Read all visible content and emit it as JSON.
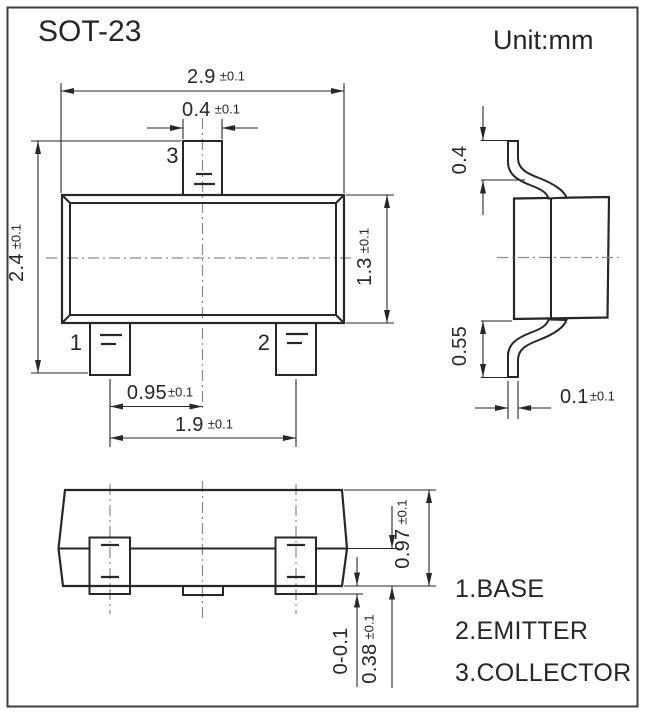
{
  "title": "SOT-23",
  "unit_label": "Unit:mm",
  "colors": {
    "ink": "#26262b",
    "centerline": "#8a8a8a",
    "border": "#3e3e46",
    "background": "#ffffff"
  },
  "front_view": {
    "pin1_label": "1",
    "pin2_label": "2",
    "pin3_label": "3",
    "dim_body_width": {
      "value": "2.9",
      "tol": "±0.1"
    },
    "dim_pin3_width": {
      "value": "0.4",
      "tol": "±0.1"
    },
    "dim_overall_height": {
      "value": "2.4",
      "tol": "±0.1"
    },
    "dim_body_height": {
      "value": "1.3",
      "tol": "±0.1"
    },
    "dim_pin_pitch": {
      "value": "0.95",
      "tol": "±0.1"
    },
    "dim_pin_span": {
      "value": "1.9",
      "tol": "±0.1"
    }
  },
  "side_view": {
    "dim_top_lead": {
      "value": "0.4"
    },
    "dim_bottom_lead": {
      "value": "0.55"
    },
    "dim_lead_thickness": {
      "value": "0.1",
      "tol": "±0.1"
    }
  },
  "bottom_view": {
    "dim_body_depth": {
      "value": "0.97",
      "tol": "±0.1"
    },
    "dim_lead_protrusion": {
      "value": "0-0.1"
    },
    "dim_pad_height": {
      "value": "0.38",
      "tol": "±0.1"
    }
  },
  "pin_functions": {
    "pin1": "1.BASE",
    "pin2": "2.EMITTER",
    "pin3": "3.COLLECTOR"
  }
}
